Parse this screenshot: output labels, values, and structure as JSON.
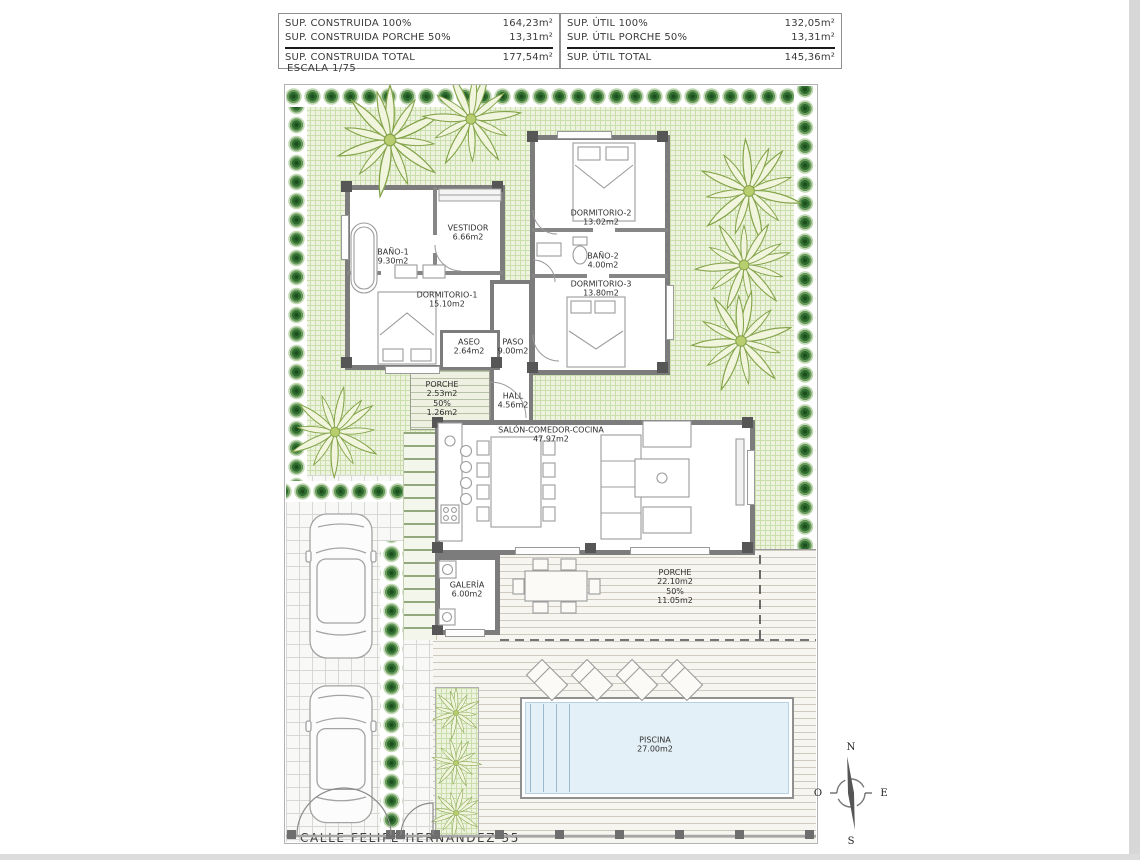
{
  "header": {
    "scale_label": "ESCALA 1/75",
    "summary_left": {
      "row1_label": "SUP. CONSTRUIDA 100%",
      "row1_value": "164,23m²",
      "row2_label": "SUP. CONSTRUIDA PORCHE 50%",
      "row2_value": "13,31m²",
      "total_label": "SUP. CONSTRUIDA TOTAL",
      "total_value": "177,54m²"
    },
    "summary_right": {
      "row1_label": "SUP. ÚTIL 100%",
      "row1_value": "132,05m²",
      "row2_label": "SUP. ÚTIL PORCHE 50%",
      "row2_value": "13,31m²",
      "total_label": "SUP. ÚTIL TOTAL",
      "total_value": "145,36m²"
    }
  },
  "rooms": {
    "bano1": {
      "name": "BAÑO-1",
      "area": "9.30m2"
    },
    "vestidor": {
      "name": "VESTIDOR",
      "area": "6.66m2"
    },
    "dormitorio1": {
      "name": "DORMITORIO-1",
      "area": "15.10m2"
    },
    "dormitorio2": {
      "name": "DORMITORIO-2",
      "area": "13.02m2"
    },
    "bano2": {
      "name": "BAÑO-2",
      "area": "4.00m2"
    },
    "dormitorio3": {
      "name": "DORMITORIO-3",
      "area": "13.80m2"
    },
    "aseo": {
      "name": "ASEO",
      "area": "2.64m2"
    },
    "paso": {
      "name": "PASO",
      "area": "9.00m2"
    },
    "hall": {
      "name": "HALL",
      "area": "4.56m2"
    },
    "salon": {
      "name": "SALÓN-COMEDOR-COCINA",
      "area": "47.97m2"
    },
    "galeria": {
      "name": "GALERÍA",
      "area": "6.00m2"
    },
    "porche_entrada": {
      "name": "PORCHE",
      "area": "2.53m2",
      "percent": "50%",
      "area_50": "1.26m2"
    },
    "porche_trasero": {
      "name": "PORCHE",
      "area": "22.10m2",
      "percent": "50%",
      "area_50": "11.05m2"
    },
    "piscina": {
      "name": "PISCINA",
      "area": "27.00m2"
    }
  },
  "footer": {
    "street_label": "CALLE FELIPE HERNÁNDEZ 35"
  },
  "compass": {
    "north": "N",
    "south": "S",
    "east": "E",
    "west": "O"
  },
  "colors": {
    "lawn": "#eef3e0",
    "bush": "#2e6b2e",
    "palm": "#85a44a",
    "wall": "#7c7c7c",
    "pool_water": "#e4f0f8"
  }
}
